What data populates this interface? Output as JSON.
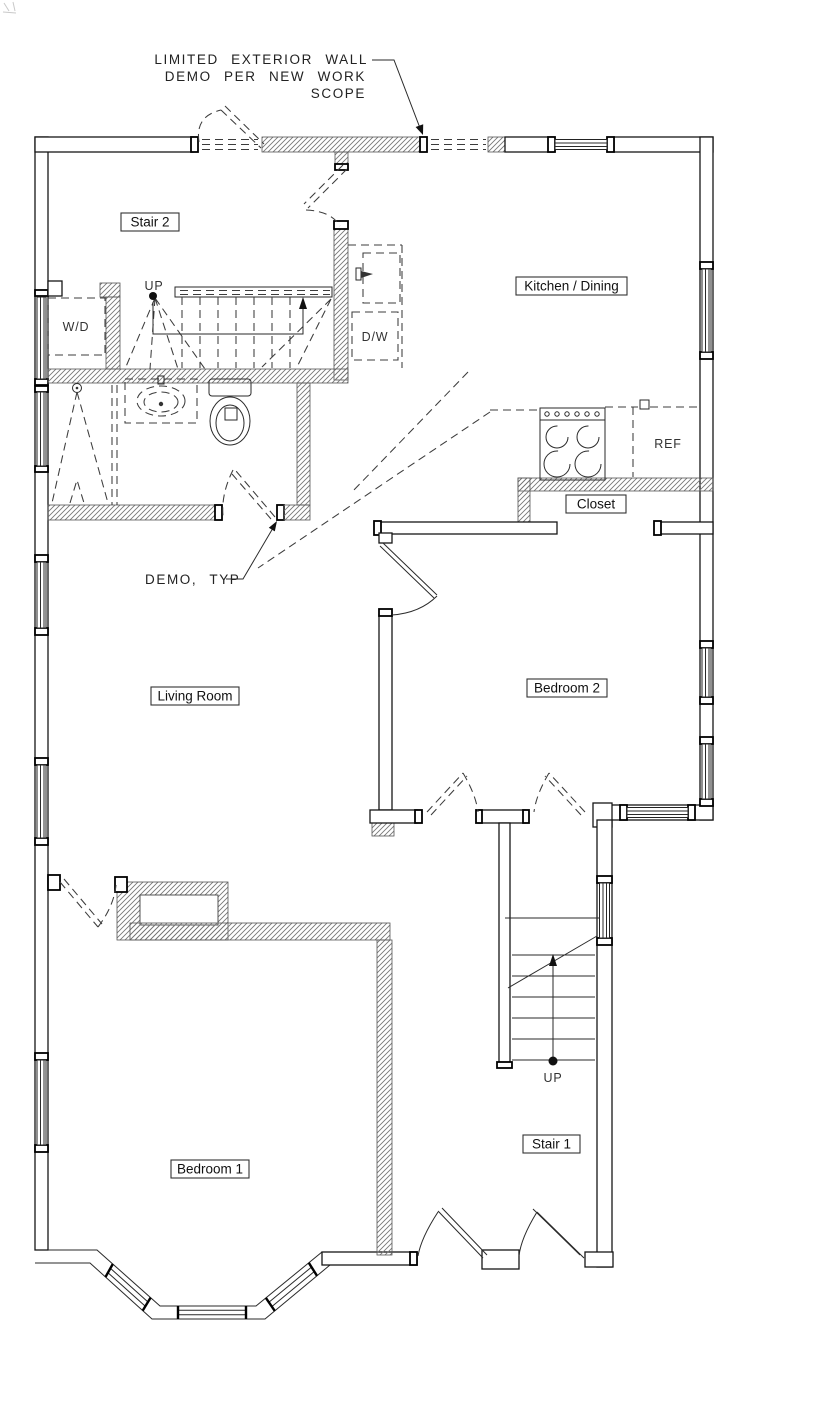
{
  "callouts": {
    "exterior_wall_note": [
      "LIMITED EXTERIOR WALL",
      "DEMO PER NEW WORK",
      "SCOPE"
    ],
    "demo_typ": "DEMO, TYP"
  },
  "rooms": {
    "stair2": "Stair 2",
    "kitchen_dining": "Kitchen / Dining",
    "closet": "Closet",
    "living_room": "Living Room",
    "bedroom2": "Bedroom 2",
    "bedroom1": "Bedroom 1",
    "stair1": "Stair 1"
  },
  "fixtures": {
    "washer_dryer": "W/D",
    "dishwasher": "D/W",
    "refrigerator": "REF"
  },
  "stair_direction": {
    "stair2_up": "UP",
    "stair1_up": "UP"
  },
  "colors": {
    "background": "#ffffff",
    "wall_line": "#161616",
    "demo_dash": "#3c3c3c",
    "hatch": "#777777"
  }
}
